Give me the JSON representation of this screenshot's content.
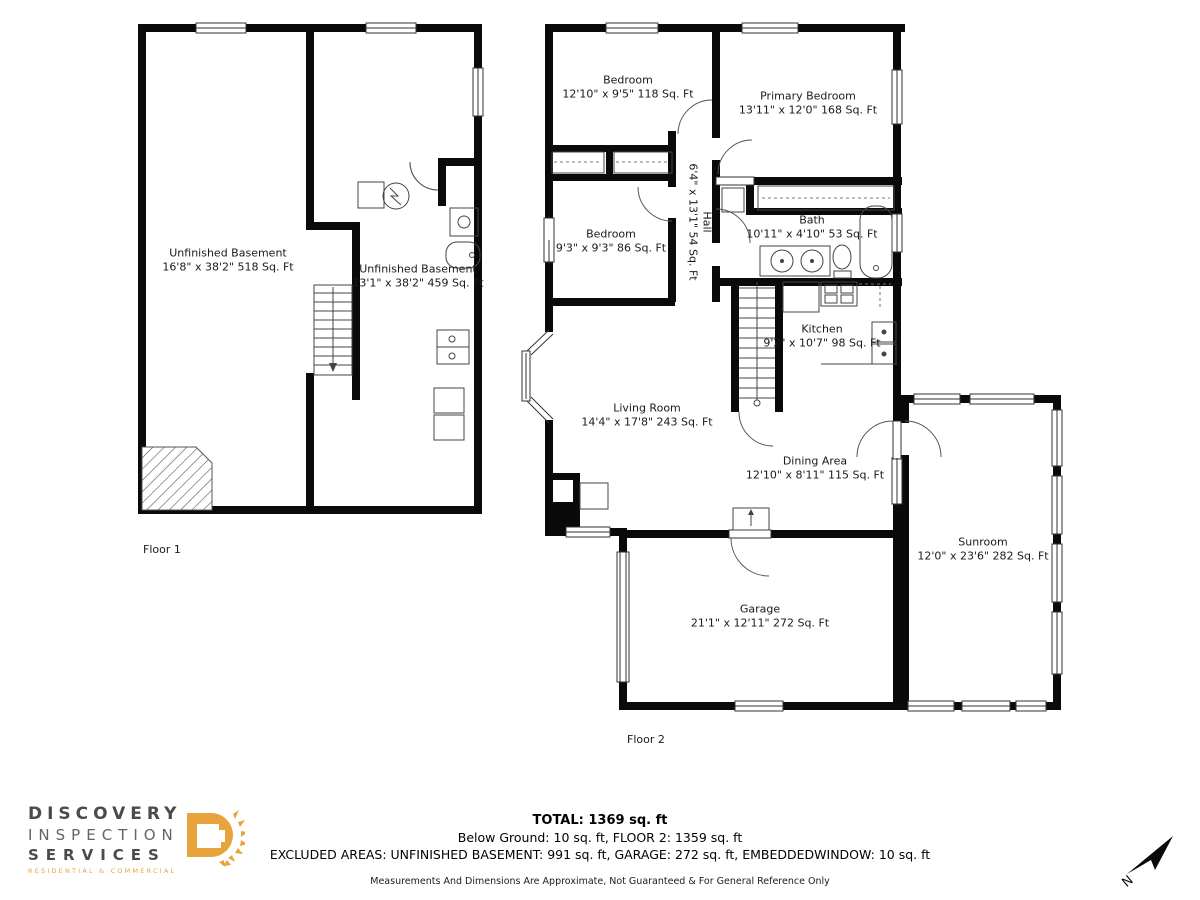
{
  "floor1": {
    "label": "Floor 1",
    "rooms": [
      {
        "name": "Unfinished Basement",
        "dims": "16'8\" x 38'2\" 518 Sq. Ft"
      },
      {
        "name": "Unfinished Basement",
        "dims": "13'1\" x 38'2\" 459 Sq. Ft"
      }
    ]
  },
  "floor2": {
    "label": "Floor 2",
    "rooms": [
      {
        "name": "Bedroom",
        "dims": "12'10\" x 9'5\" 118 Sq. Ft"
      },
      {
        "name": "Primary Bedroom",
        "dims": "13'11\" x 12'0\" 168 Sq. Ft"
      },
      {
        "name": "Bedroom",
        "dims": "9'3\" x 9'3\" 86 Sq. Ft"
      },
      {
        "name": "Hall",
        "dims": "6'4\" x 13'1\" 54 Sq. Ft"
      },
      {
        "name": "Bath",
        "dims": "10'11\" x 4'10\" 53 Sq. Ft"
      },
      {
        "name": "Kitchen",
        "dims": "9'2\" x 10'7\" 98 Sq. Ft"
      },
      {
        "name": "Living Room",
        "dims": "14'4\" x 17'8\" 243 Sq. Ft"
      },
      {
        "name": "Dining Area",
        "dims": "12'10\" x 8'11\" 115 Sq. Ft"
      },
      {
        "name": "Sunroom",
        "dims": "12'0\" x 23'6\" 282 Sq. Ft"
      },
      {
        "name": "Garage",
        "dims": "21'1\" x 12'11\" 272 Sq. Ft"
      }
    ]
  },
  "summary": {
    "total": "TOTAL: 1369 sq. ft",
    "breakdown": "Below Ground: 10 sq. ft, FLOOR 2: 1359 sq. ft",
    "excluded": "EXCLUDED AREAS: UNFINISHED BASEMENT: 991 sq. ft, GARAGE: 272 sq. ft, EMBEDDEDWINDOW: 10 sq. ft",
    "disclaimer": "Measurements And Dimensions Are Approximate, Not Guaranteed & For General Reference Only"
  },
  "logo": {
    "line1": "DISCOVERY",
    "line2": "INSPECTION",
    "line3": "SERVICES",
    "tagline": "RESIDENTIAL & COMMERCIAL",
    "accent_color": "#e8a33c",
    "dark_color": "#4a4b4e"
  },
  "compass": {
    "label": "N"
  }
}
